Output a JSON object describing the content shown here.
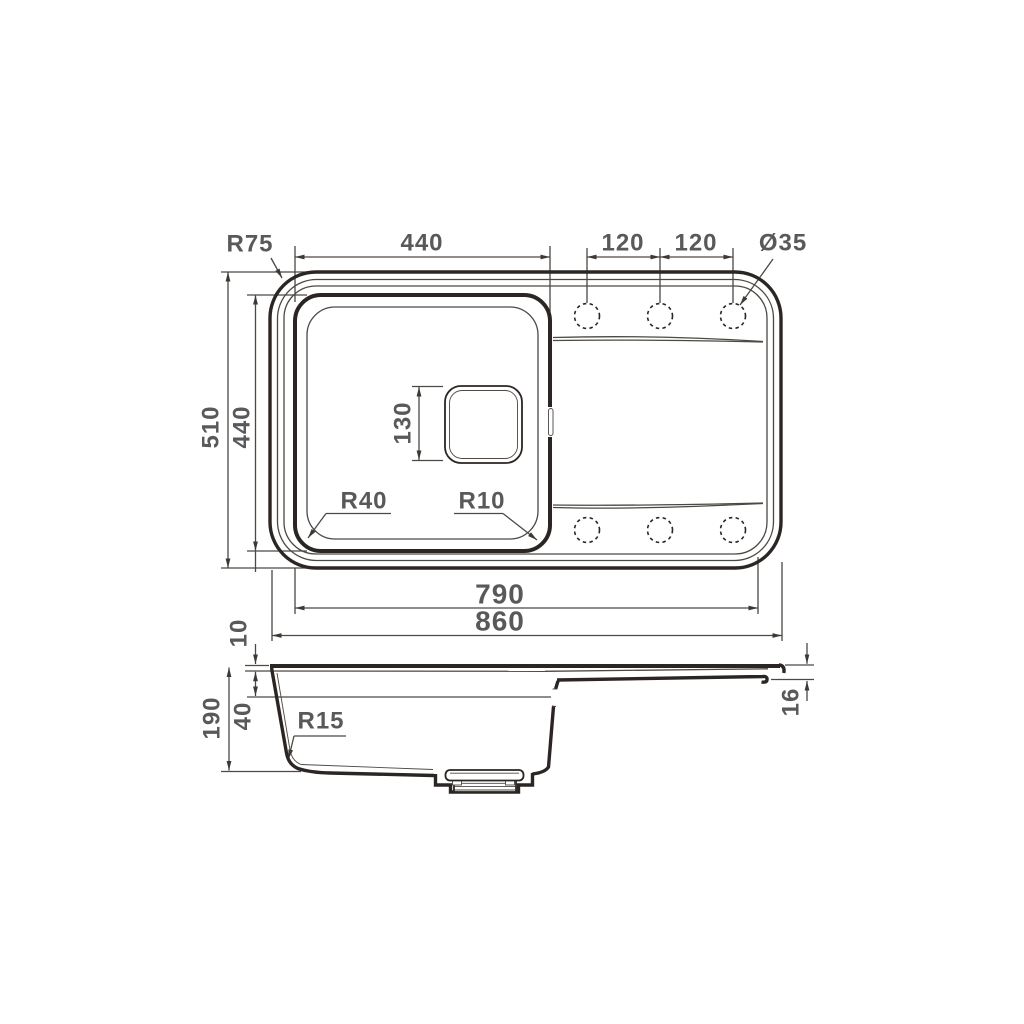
{
  "colors": {
    "line": "#2b2623",
    "dimension_line": "#4c4843",
    "text": "#58595b",
    "background": "#ffffff"
  },
  "diagram": {
    "type": "technical-drawing",
    "subject": "Kitchen sink with drainboard - top view and side profile with dimensions",
    "units": "mm",
    "top_view": {
      "corner_radius": "R75",
      "bowl_width": "440",
      "tap_spacing_left": "120",
      "tap_spacing_right": "120",
      "tap_hole_diameter": "Ø35",
      "overall_depth": "510",
      "bowl_depth": "440",
      "drain_size": "130",
      "bowl_corner_radius": "R40",
      "bowl_inner_radius": "R10",
      "rim_width": "790",
      "overall_width": "860"
    },
    "side_view": {
      "rim_thickness": "10",
      "ledge_depth": "40",
      "total_depth": "190",
      "bottom_corner_radius": "R15",
      "drainboard_thickness": "16"
    }
  }
}
